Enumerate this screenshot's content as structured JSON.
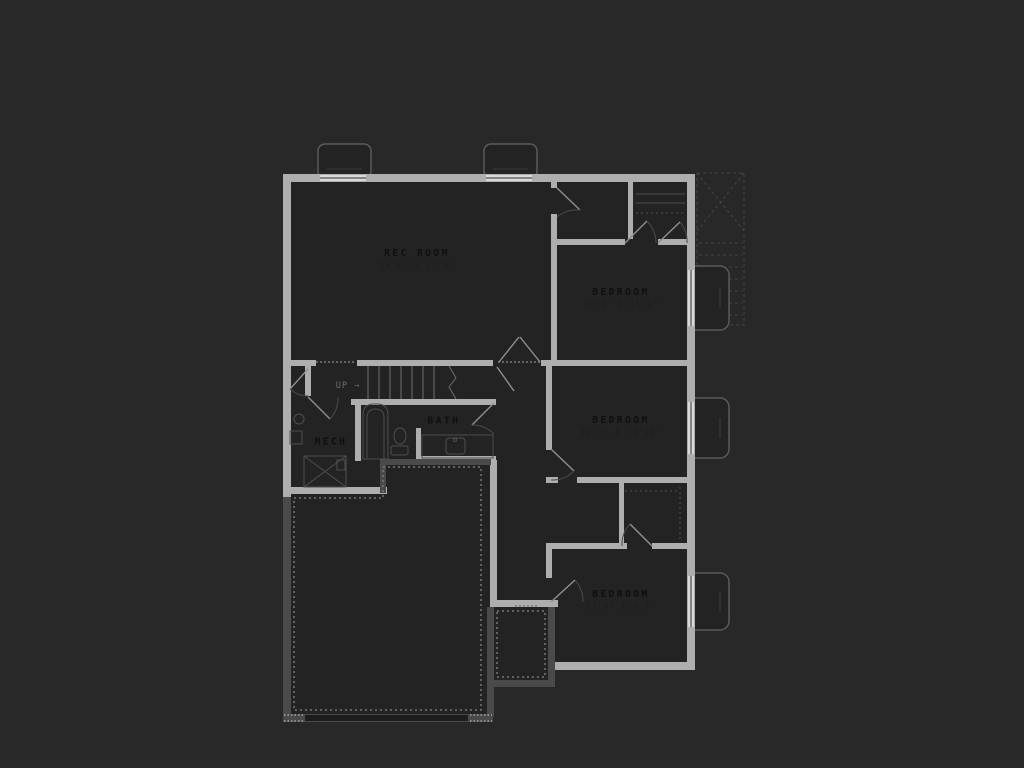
{
  "colors": {
    "page-bg": "#282828",
    "floor": "#232323",
    "wall": "#aeaeae",
    "wall-dark": "#4a4a4a",
    "window": "#d9d9d9",
    "fixture": "#4e4e4e",
    "label": "#0f0f0f",
    "dim": "#1d1d1d"
  },
  "floorplan": {
    "title": "basement floor plan",
    "rooms": [
      {
        "id": "rec-room",
        "label": "REC ROOM",
        "dims": "25'5\" X 17'0\""
      },
      {
        "id": "bedroom-1",
        "label": "BEDROOM",
        "dims": "12'3\" X 11'6\""
      },
      {
        "id": "bedroom-2",
        "label": "BEDROOM",
        "dims": "12'3\" X 10'10\""
      },
      {
        "id": "bedroom-3",
        "label": "BEDROOM",
        "dims": "11'0\" X 9'7\""
      },
      {
        "id": "bath",
        "label": "BATH",
        "dims": ""
      },
      {
        "id": "mech",
        "label": "MECH",
        "dims": ""
      }
    ],
    "stairs": {
      "label": "UP",
      "arrow": "→"
    }
  }
}
